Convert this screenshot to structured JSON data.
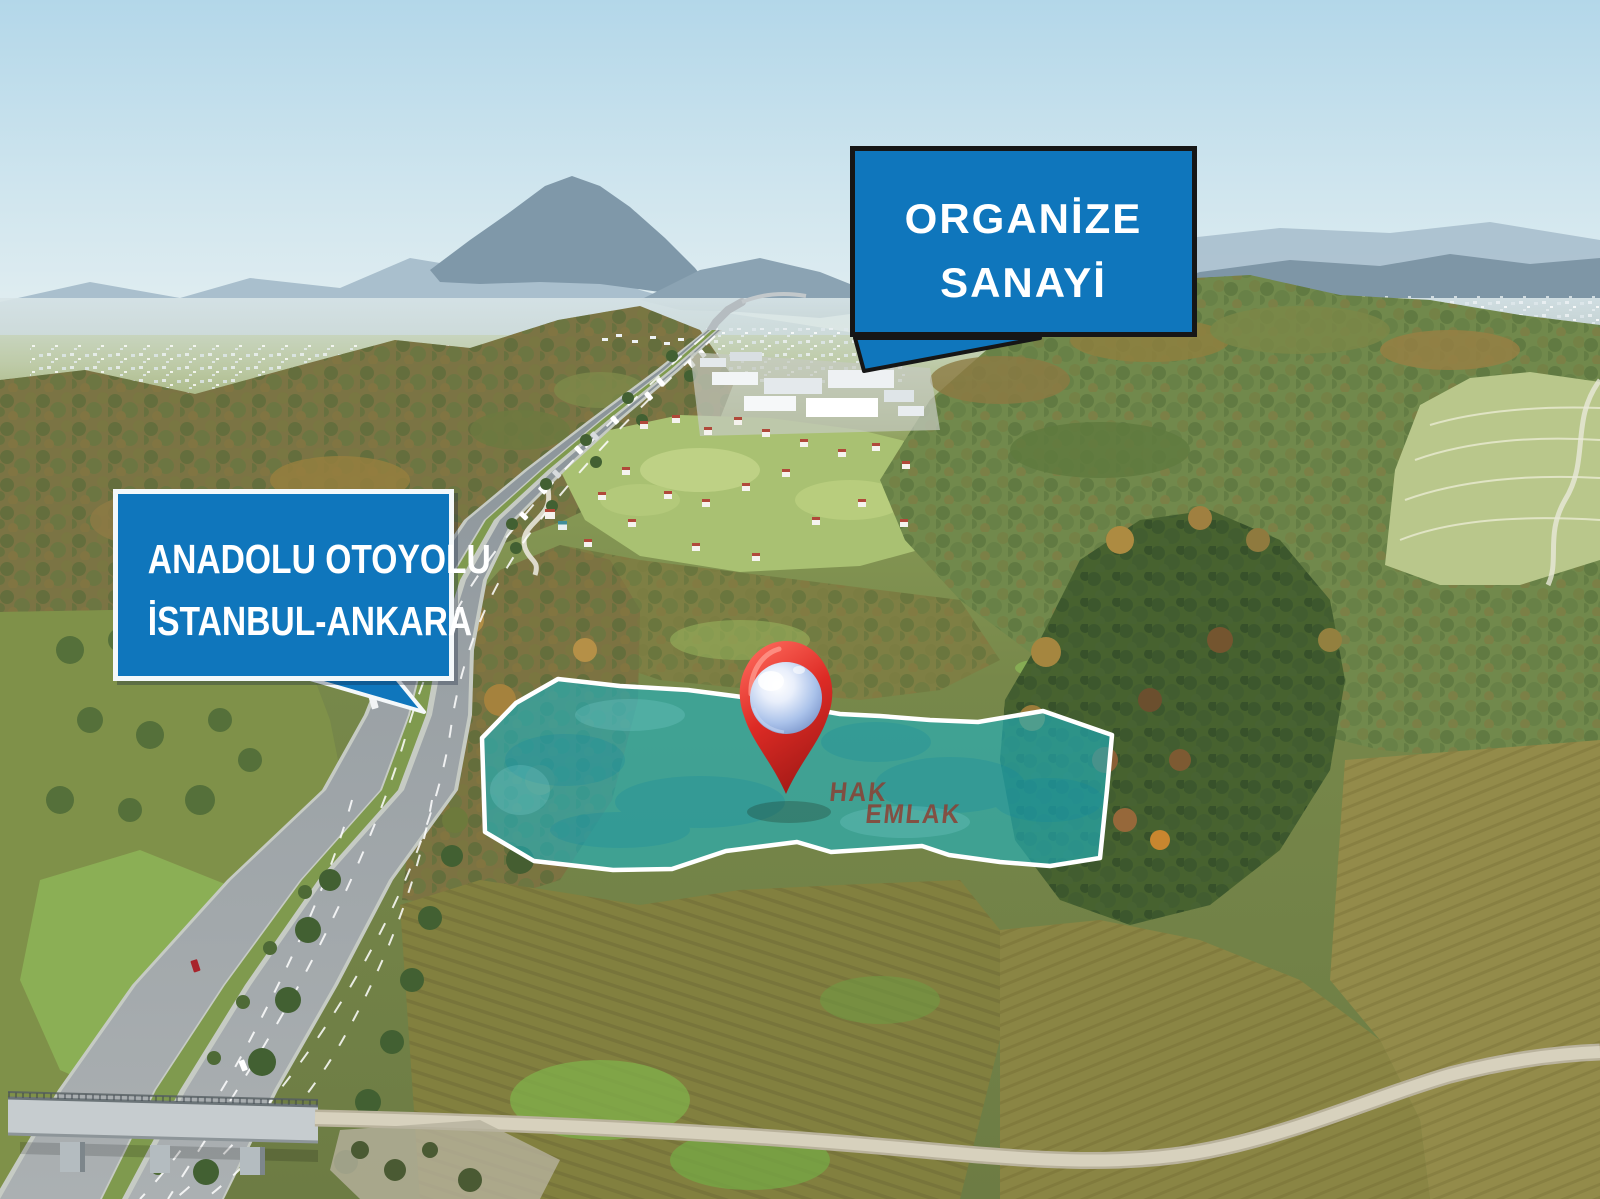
{
  "annotations": {
    "organize_sanayi_callout": {
      "lines": [
        "ORGANİZE",
        "SANAYİ"
      ],
      "fill": "#0f76bc",
      "border_color": "#161616",
      "text_color": "#ffffff"
    },
    "anadolu_otoyolu_callout": {
      "lines": [
        "ANADOLU OTOYOLU",
        "İSTANBUL-ANKARA"
      ],
      "fill": "#0f76bc",
      "border_color": "#ffffff",
      "text_color": "#ffffff"
    },
    "watermark": {
      "lines": [
        "HAK",
        "EMLAK"
      ],
      "color": "#8b3f33"
    },
    "parcel_highlight": {
      "fill": "#1db4c4",
      "fill_opacity": "0.6",
      "stroke": "#ffffff"
    },
    "map_pin": {
      "body_color": "#dd2b25",
      "sphere_color": "#aac2ea"
    }
  }
}
